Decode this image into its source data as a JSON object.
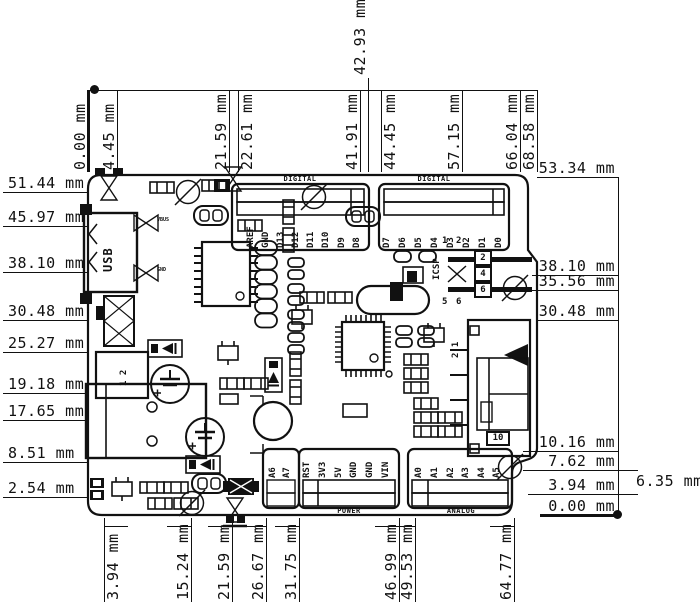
{
  "colors": {
    "ink": "#111111",
    "background": "#ffffff"
  },
  "dims": {
    "top": [
      {
        "label": "0.00 mm",
        "x": 88,
        "style": "datum"
      },
      {
        "label": "4.45 mm",
        "x": 117
      },
      {
        "label": "21.59 mm",
        "x": 229
      },
      {
        "label": "22.61 mm",
        "x": 238,
        "side": "right"
      },
      {
        "label": "41.91 mm",
        "x": 360
      },
      {
        "label": "42.93 mm",
        "x": 368,
        "style": "tall"
      },
      {
        "label": "44.45 mm",
        "x": 381,
        "side": "right"
      },
      {
        "label": "57.15 mm",
        "x": 462
      },
      {
        "label": "66.04 mm",
        "x": 520
      },
      {
        "label": "68.58 mm",
        "x": 537
      }
    ],
    "left": [
      {
        "label": "51.44 mm",
        "y": 192
      },
      {
        "label": "45.97 mm",
        "y": 226
      },
      {
        "label": "38.10 mm",
        "y": 272
      },
      {
        "label": "30.48 mm",
        "y": 320
      },
      {
        "label": "25.27 mm",
        "y": 352
      },
      {
        "label": "19.18 mm",
        "y": 393
      },
      {
        "label": "17.65 mm",
        "y": 420
      },
      {
        "label": "8.51 mm",
        "y": 462
      },
      {
        "label": "2.54 mm",
        "y": 497
      }
    ],
    "right": [
      {
        "label": "53.34 mm",
        "y": 177,
        "x0": 537
      },
      {
        "label": "38.10 mm",
        "y": 275,
        "x0": 532
      },
      {
        "label": "35.56 mm",
        "y": 290,
        "x0": 532
      },
      {
        "label": "30.48 mm",
        "y": 320,
        "x0": 537
      },
      {
        "label": "10.16 mm",
        "y": 451,
        "x0": 523
      },
      {
        "label": "7.62 mm",
        "y": 470,
        "x0": 523
      },
      {
        "label": "3.94 mm",
        "y": 494,
        "x0": 528
      },
      {
        "label": "0.00 mm",
        "y": 515,
        "x0": 540,
        "style": "datum"
      }
    ],
    "right_offset": {
      "label": "6.35 mm"
    },
    "bottom": [
      {
        "label": "3.94 mm",
        "x": 104,
        "side": "right"
      },
      {
        "label": "15.24 mm",
        "x": 191
      },
      {
        "label": "21.59 mm",
        "x": 232
      },
      {
        "label": "26.67 mm",
        "x": 266
      },
      {
        "label": "31.75 mm",
        "x": 299
      },
      {
        "label": "46.99 mm",
        "x": 399
      },
      {
        "label": "49.53 mm",
        "x": 415
      },
      {
        "label": "64.77 mm",
        "x": 514
      }
    ]
  },
  "headers": {
    "digital_left": {
      "title": "DIGITAL",
      "tx": 300,
      "ty": 176,
      "label_bottom": 248,
      "pins": [
        "AREF",
        "GND",
        "D13",
        "D12",
        "D11",
        "D10",
        "D9",
        "D8"
      ],
      "x": [
        250,
        265,
        280,
        295,
        310,
        325,
        341,
        356
      ]
    },
    "digital_right": {
      "title": "DIGITAL",
      "tx": 434,
      "ty": 176,
      "label_bottom": 248,
      "pins": [
        "D7",
        "D6",
        "D5",
        "D4",
        "D3",
        "D2",
        "D1",
        "D0"
      ],
      "x": [
        386,
        402,
        418,
        434,
        450,
        466,
        482,
        498
      ]
    },
    "aux": {
      "label_bottom": 478,
      "pins": [
        "A6",
        "A7"
      ],
      "x": [
        272,
        286
      ]
    },
    "power": {
      "title": "POWER",
      "tx": 349,
      "ty": 508,
      "label_bottom": 478,
      "pins": [
        "RST",
        "3V3",
        "5V",
        "GND",
        "GND",
        "VIN"
      ],
      "x": [
        306,
        322,
        338,
        353,
        369,
        385
      ]
    },
    "analog": {
      "title": "ANALOG",
      "tx": 461,
      "ty": 508,
      "label_bottom": 478,
      "pins": [
        "A0",
        "A1",
        "A2",
        "A3",
        "A4",
        "A5"
      ],
      "x": [
        418,
        434,
        450,
        465,
        481,
        496
      ]
    }
  },
  "components": {
    "usb_label": "USB",
    "icsp_label": "ICSP",
    "icsp_pins": [
      "2",
      "4",
      "6"
    ],
    "icsp_pin_numbers_top": [
      "1",
      "2"
    ],
    "icsp_pin_numbers_bottom": [
      "5",
      "6"
    ],
    "connector_2x1_pins": "1 2",
    "right_connector_pins": "2 1",
    "right_connector_tag": "10",
    "testpoint_labels": [
      "VBUS",
      "GND"
    ]
  }
}
